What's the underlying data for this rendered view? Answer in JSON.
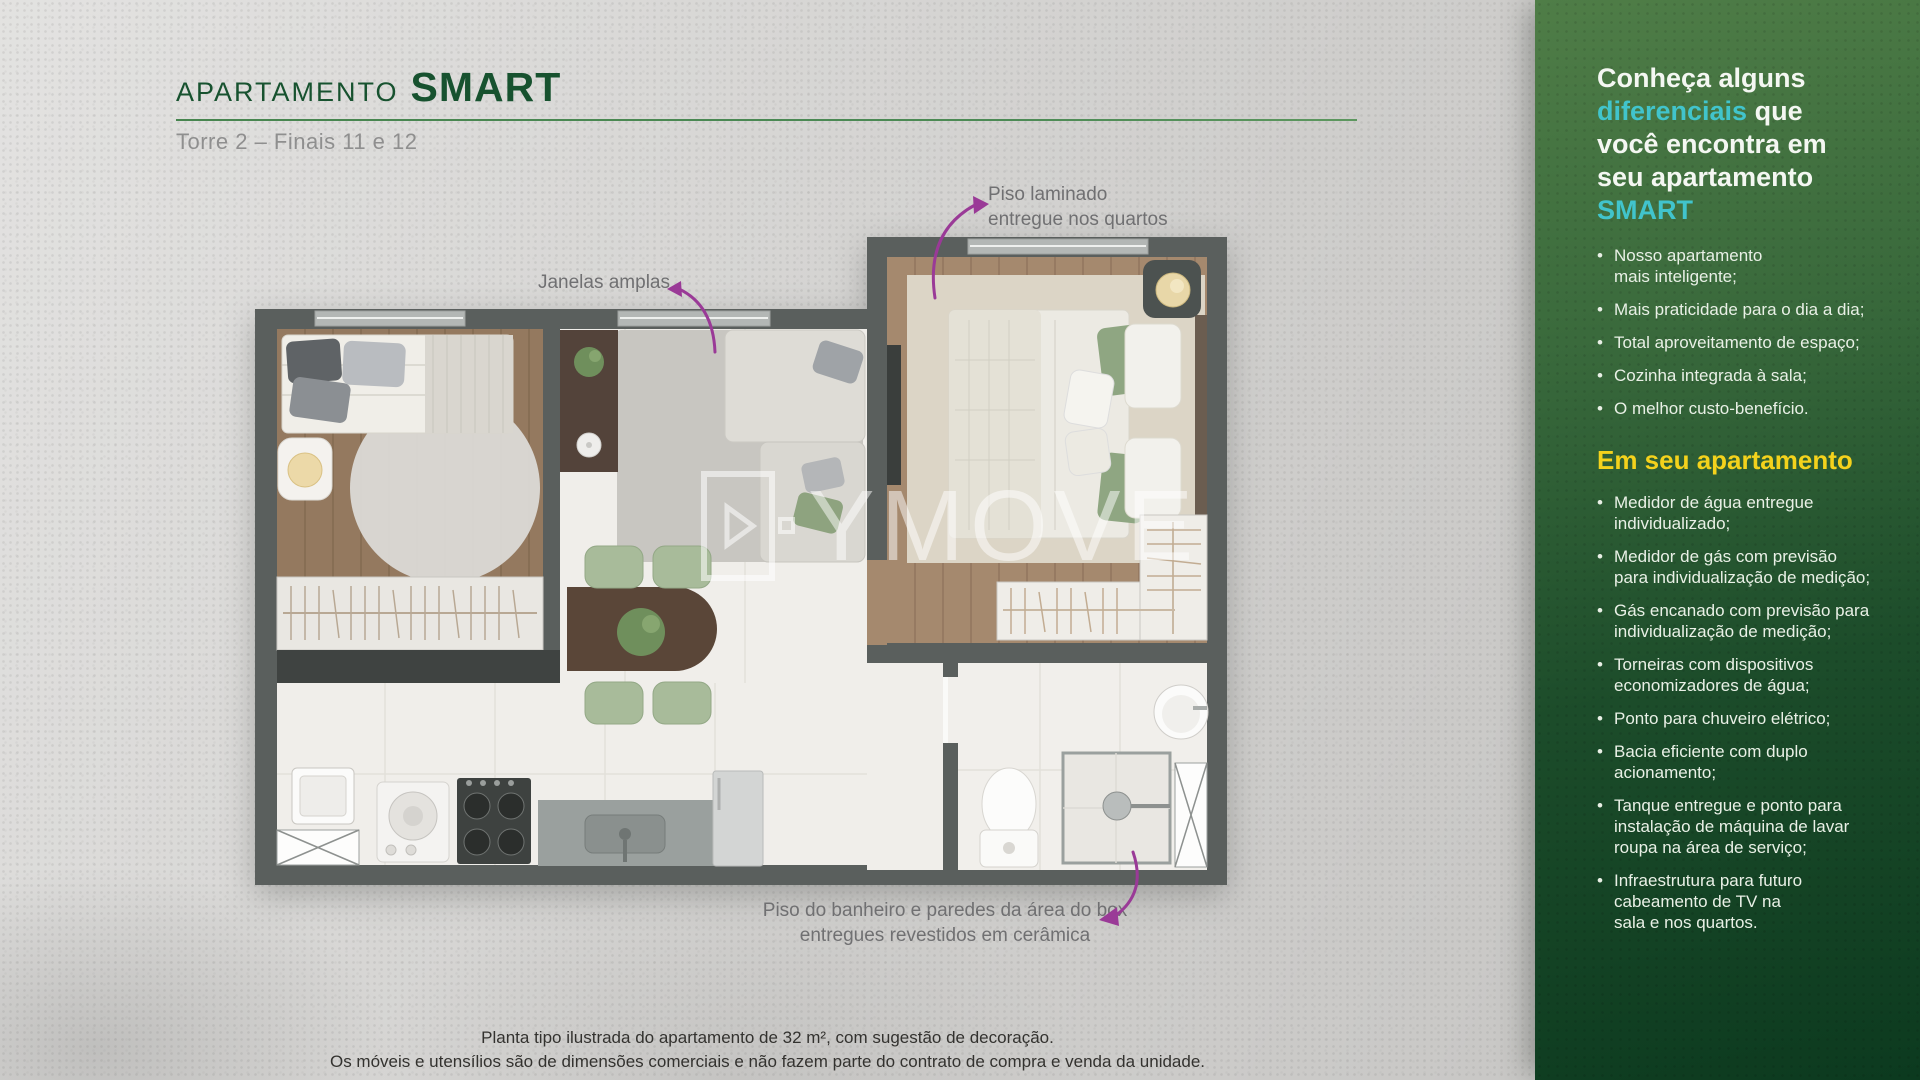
{
  "header": {
    "title_prefix": "APARTAMENTO",
    "title_name": "SMART",
    "subtitle": "Torre 2 – Finais 11 e 12"
  },
  "floorplan": {
    "watermark_text": "YMOVE",
    "annotation_windows": "Janelas amplas",
    "annotation_laminate": "Piso laminado\nentregue nos quartos",
    "annotation_bathroom": "Piso do banheiro e paredes da área do box\nentregues revestidos em cerâmica"
  },
  "disclaimer": {
    "line1": "Planta tipo ilustrada do apartamento de 32 m², com sugestão de decoração.",
    "line2": "Os móveis e utensílios são de dimensões comerciais e não fazem parte do contrato de compra e venda da unidade."
  },
  "sidebar": {
    "intro": {
      "line1": "Conheça alguns",
      "line2_highlight": "diferenciais",
      "line2_rest": " que",
      "line3": "você encontra em",
      "line4": "seu apartamento",
      "line5": "SMART"
    },
    "differentials": [
      "Nosso apartamento\nmais inteligente;",
      "Mais praticidade para o dia a dia;",
      "Total aproveitamento de espaço;",
      "Cozinha integrada à sala;",
      "O melhor custo-benefício."
    ],
    "section_title": "Em seu apartamento",
    "features": [
      "Medidor de água entregue\nindividualizado;",
      "Medidor de gás com previsão\npara individualização de medição;",
      "Gás encanado com previsão para\nindividualização de medição;",
      "Torneiras com dispositivos\neconomizadores de água;",
      "Ponto para chuveiro elétrico;",
      "Bacia eficiente com duplo\nacionamento;",
      "Tanque entregue e ponto para\ninstalação de máquina de lavar\nroupa na área de serviço;",
      "Infraestrutura para futuro\ncabeamento de TV na\nsala e nos quartos."
    ],
    "colors": {
      "highlight_teal": "#41c4cc",
      "section_yellow": "#f4d21c",
      "panel_top_green": "#4f7d47",
      "panel_bottom_green": "#0c3a1f",
      "title_green": "#17522f",
      "arrow_purple": "#9a3a97"
    }
  }
}
